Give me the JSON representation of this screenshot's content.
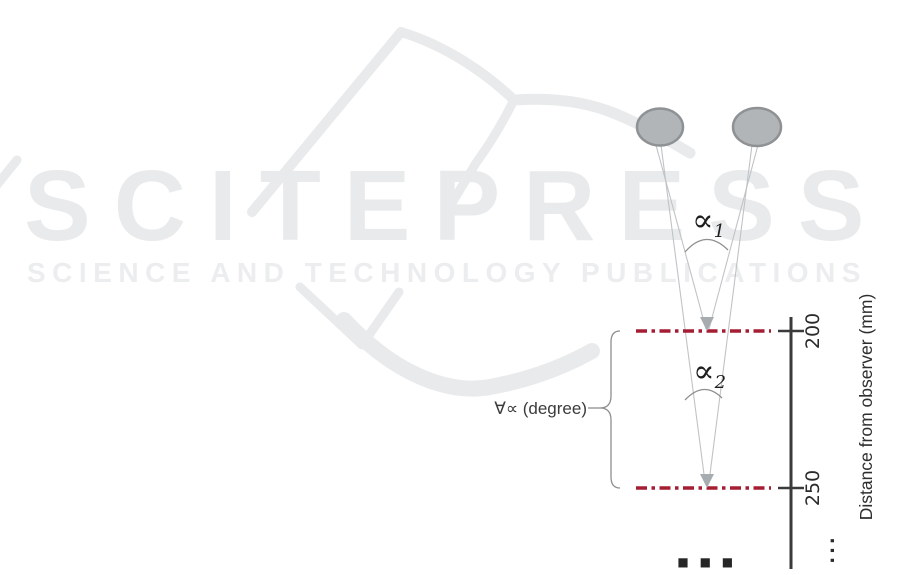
{
  "watermark": {
    "logo_text": "SCITEPRESS",
    "tagline": "SCIENCE AND TECHNOLOGY PUBLICATIONS"
  },
  "labels": {
    "alpha1_symbol": "∝",
    "alpha1_sub": "1",
    "alpha2_symbol": "∝",
    "alpha2_sub": "2",
    "range": "∀∝ (degree)",
    "axis_title": "Distance from observer (mm)",
    "tick_near": "200",
    "tick_far": "250",
    "axis_continuation": "...",
    "bottom_continuation": "■ ■ ■"
  },
  "colors": {
    "watermark": "#e8eaec",
    "dashed_line": "#a51d33",
    "axis": "#3a3a3a",
    "eye_fill": "#b2b5b7",
    "eye_stroke": "#8e9294",
    "sight_line": "#c0c3c6",
    "arrow": "#a7acb1",
    "annotation": "#8f8f8f"
  }
}
